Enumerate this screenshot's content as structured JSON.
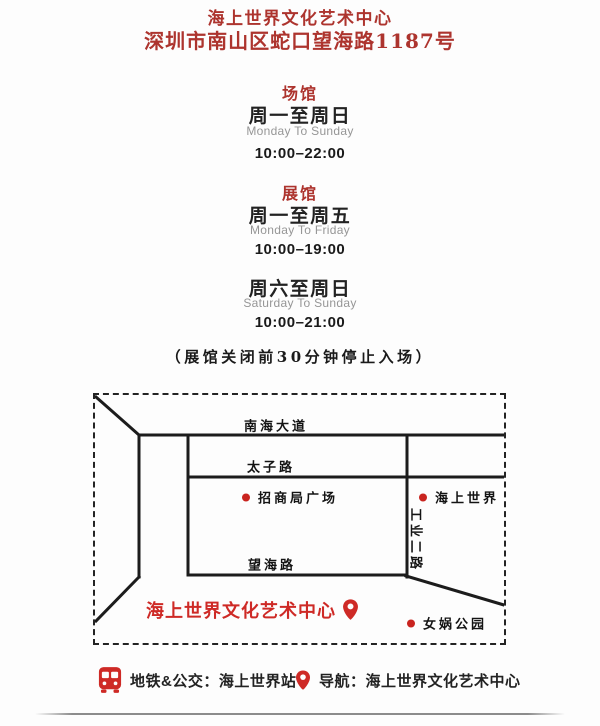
{
  "header": {
    "title": "海上世界文化艺术中心",
    "address": "深圳市南山区蛇口望海路1187号"
  },
  "hours": {
    "venue_label": "场馆",
    "venue": {
      "days_cn": "周一至周日",
      "days_en": "Monday To Sunday",
      "time": "10:00–22:00"
    },
    "exhibition_label": "展馆",
    "exhibition_weekday": {
      "days_cn": "周一至周五",
      "days_en": "Monday To Friday",
      "time": "10:00–19:00"
    },
    "exhibition_weekend": {
      "days_cn": "周六至周日",
      "days_en": "Saturday To Sunday",
      "time": "10:00–21:00"
    },
    "note": "（展馆关闭前30分钟停止入场）"
  },
  "map": {
    "road_nanhai": "南海大道",
    "road_taizi": "太子路",
    "road_wanghai": "望海路",
    "road_gongye": "工业二路",
    "poi_zhaoshang": "招商局广场",
    "poi_seaworld": "海上世界",
    "poi_nuwa": "女娲公园",
    "poi_center": "海上世界文化艺术中心"
  },
  "legend": {
    "transit": "地铁&公交：海上世界站",
    "navigation": "导航：海上世界文化艺术中心"
  },
  "icons": {
    "bus": "bus-icon",
    "pin": "location-pin-icon",
    "dot": "poi-dot"
  },
  "colors": {
    "heading_red": "#ad342e",
    "accent_red": "#ce2a26",
    "text_black": "#1d1d1d",
    "muted_gray": "#969696",
    "road_line": "#1c1c1c"
  }
}
